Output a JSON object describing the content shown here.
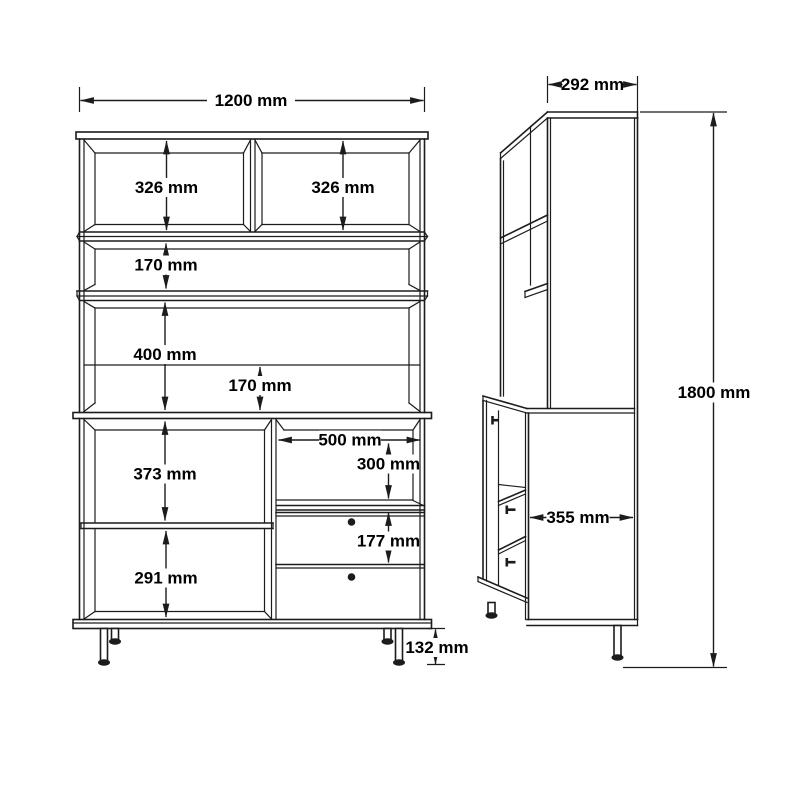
{
  "drawing": {
    "front_view": {
      "total_width": "1200 mm",
      "top_left_shelf_height": "326 mm",
      "top_right_shelf_height": "326 mm",
      "middle_shelf_gap": "170 mm",
      "lower_hutch_section_height": "400 mm",
      "back_opening_height": "170 mm",
      "cabinet_left_upper_height": "373 mm",
      "cabinet_left_lower_height": "291 mm",
      "niche_width": "500 mm",
      "niche_height": "300 mm",
      "drawer_pitch": "177 mm",
      "leg_height": "132 mm"
    },
    "side_view": {
      "hutch_depth": "292 mm",
      "total_height": "1800 mm",
      "cabinet_depth": "355 mm"
    },
    "colors": {
      "line": "#1c1c1c",
      "background": "#ffffff"
    }
  }
}
